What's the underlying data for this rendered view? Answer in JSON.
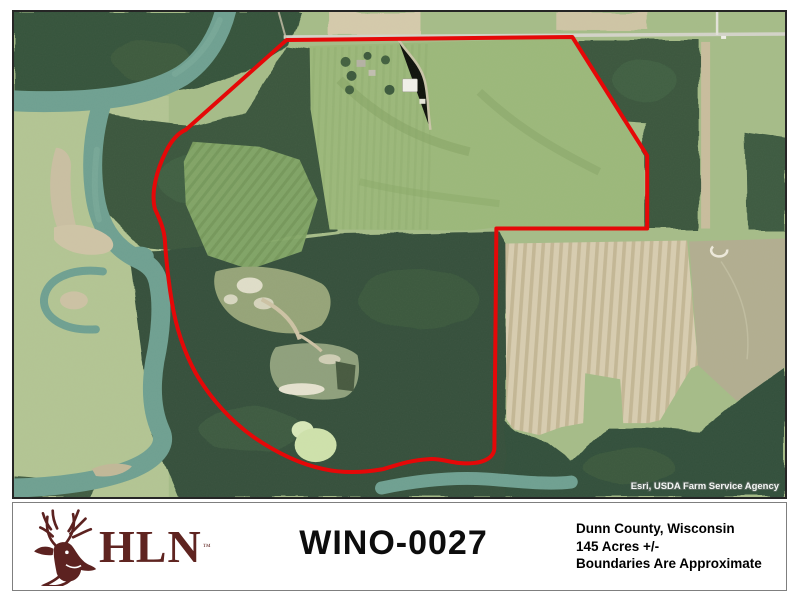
{
  "footer": {
    "logo": {
      "text": "HLN",
      "trademark": "™"
    },
    "title": "WINO-0027",
    "details": [
      "Dunn County, Wisconsin",
      "145 Acres +/-",
      "Boundaries Are Approximate"
    ]
  },
  "map": {
    "attribution": "Esri, USDA Farm Service Agency",
    "colors": {
      "boundary_red": "#e50808",
      "logo_maroon": "#5f2420",
      "river_teal": "#6fa091",
      "forest_green": "#36523a",
      "field_green": "#9cb87a",
      "crop_tan": "#d5caab"
    }
  }
}
